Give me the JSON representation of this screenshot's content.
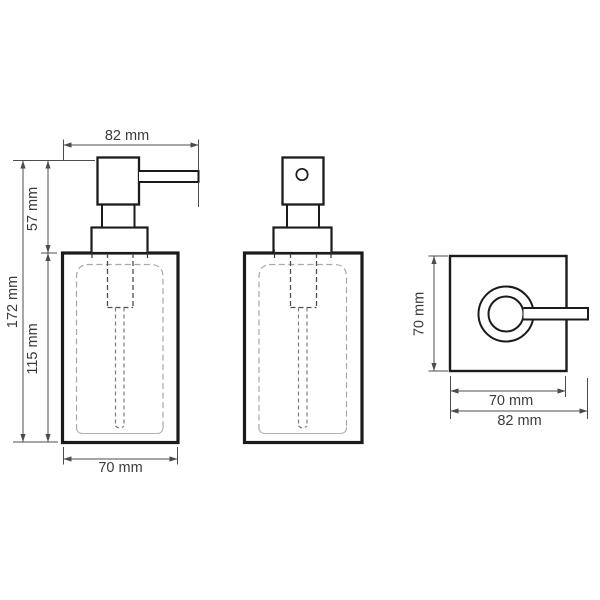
{
  "views": {
    "front": {
      "dims": {
        "width_top": "82 mm",
        "pump_height": "57 mm",
        "total_height": "172 mm",
        "body_height": "115 mm",
        "width_bottom": "70 mm"
      }
    },
    "side": {},
    "top": {
      "dims": {
        "depth": "70 mm",
        "body_width": "70 mm",
        "total_width": "82 mm"
      }
    }
  },
  "colors": {
    "outline": "#1b1b1b",
    "dimension": "#4c4c4c",
    "dash_light": "#a8a8a8",
    "dash_dark": "#4f4f4f",
    "background": "#ffffff"
  }
}
